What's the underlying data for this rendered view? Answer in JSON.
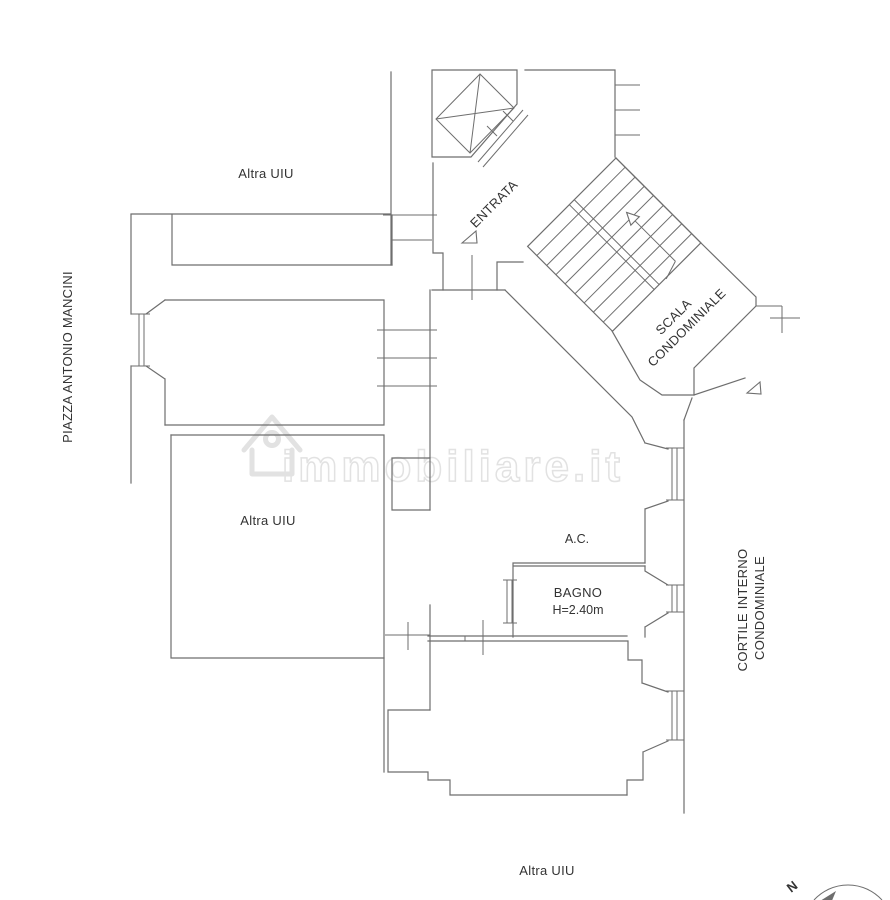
{
  "labels": {
    "piazza": "PIAZZA ANTONIO MANCINI",
    "altra_uiu_top": "Altra UIU",
    "altra_uiu_middle": "Altra UIU",
    "altra_uiu_bottom": "Altra UIU",
    "entrata": "ENTRATA",
    "scala_line1": "SCALA",
    "scala_line2": "CONDOMINIALE",
    "ac": "A.C.",
    "bagno": "BAGNO",
    "bagno_height": "H=2.40m",
    "cortile_line1": "CORTILE INTERNO",
    "cortile_line2": "CONDOMINIALE",
    "compass_north": "N"
  },
  "watermark": {
    "text": "immobiliare.it"
  },
  "colors": {
    "line": "#6e6e6e",
    "text": "#333333",
    "watermark": "#e2e2e2",
    "background": "#ffffff"
  }
}
